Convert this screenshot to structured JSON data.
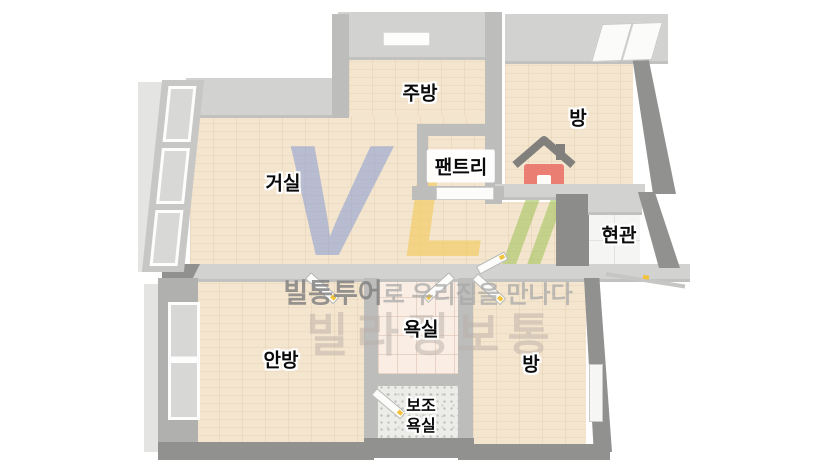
{
  "rooms": {
    "kitchen": {
      "label": "주방"
    },
    "room_top_right": {
      "label": "방"
    },
    "living": {
      "label": "거실"
    },
    "pantry": {
      "label": "팬트리"
    },
    "entrance": {
      "label": "현관"
    },
    "master_bedroom": {
      "label": "안방"
    },
    "bathroom": {
      "label": "욕실"
    },
    "aux_bathroom": {
      "label_line1": "보조",
      "label_line2": "욕실"
    },
    "room_bottom_right": {
      "label": "방"
    }
  },
  "watermark": {
    "logo_letter_v": "V",
    "logo_letter_l": "L",
    "house_icon": "house-icon",
    "tagline_brand": "빌통투어",
    "tagline_rest": "로 우리집을 만나다",
    "brand_large": "빌라정보통",
    "colors": {
      "v_blue": "#7c94d2",
      "l_yellow": "#f2c64a",
      "bars_green": "#a3c35e",
      "house_red": "#e96d64",
      "roof_gray": "#6f6f6f"
    }
  },
  "palette": {
    "floor_wood": "#f4e5ce",
    "bath_tile_pink": "#f9ede4",
    "aux_tile_speckle": "#ececec",
    "entry_tile_white": "#f5f5f3",
    "wall_light": "#d2d2d1",
    "wall_mid": "#bdbdbc",
    "wall_dark": "#919190",
    "door_handle_yellow": "#f2c23c"
  }
}
